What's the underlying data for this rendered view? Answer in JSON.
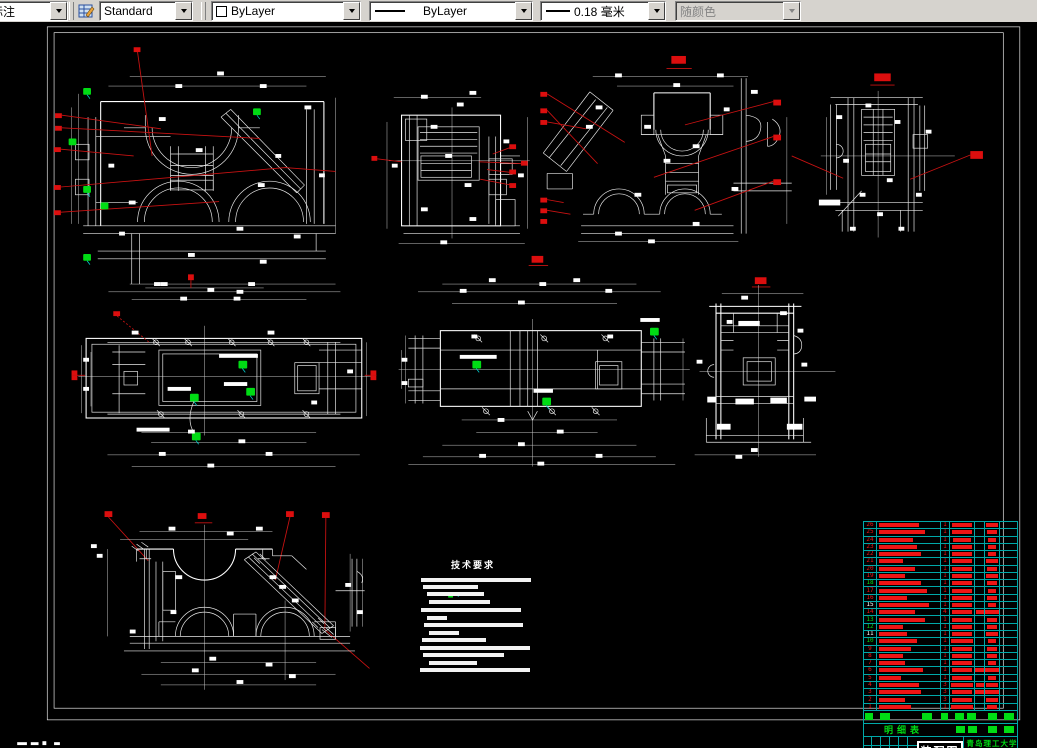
{
  "toolbar": {
    "dim_style_combo": "标注",
    "dim_style_icon": "dim-style-manager-icon",
    "text_style_combo": "Standard",
    "color_combo": "ByLayer",
    "linetype_combo": "ByLayer",
    "lineweight_combo": "0.18 毫米",
    "plotstyle_combo": "随颜色"
  },
  "colors": {
    "canvas_bg": "#000000",
    "linework": "#ffffff",
    "annotation_red": "#dc0e0e",
    "symbol_green": "#00dc14",
    "table_grid_cyan": "#00a8a8",
    "toolbar_gray": "#d6d3ce"
  },
  "drawing": {
    "tech_requirements_title": "技术要求",
    "bom_title": "明细表",
    "titleblock": {
      "drawing_name": "装配图",
      "organization": "青岛理工大学",
      "part_name": "中间体",
      "drawing_number": "KXR-2"
    }
  },
  "bom": {
    "rows": [
      {
        "n": "26",
        "nc": "red",
        "name_w": 40,
        "qty": "1",
        "mat_w": 20,
        "wt_w": 12
      },
      {
        "n": "25",
        "nc": "red",
        "name_w": 46,
        "qty": "1",
        "mat_w": 20,
        "wt_w": 10
      },
      {
        "n": "24",
        "nc": "red",
        "name_w": 34,
        "qty": "1",
        "mat_w": 18,
        "wt_w": 8
      },
      {
        "n": "23",
        "nc": "red",
        "name_w": 38,
        "qty": "1",
        "mat_w": 20,
        "wt_w": 8
      },
      {
        "n": "22",
        "nc": "red",
        "name_w": 42,
        "qty": "1",
        "mat_w": 20,
        "wt_w": 8
      },
      {
        "n": "21",
        "nc": "red",
        "name_w": 24,
        "qty": "1",
        "mat_w": 20,
        "wt_w": 12
      },
      {
        "n": "20",
        "nc": "red",
        "name_w": 36,
        "qty": "1",
        "mat_w": 20,
        "wt_w": 10
      },
      {
        "n": "19",
        "nc": "red",
        "name_w": 26,
        "qty": "1",
        "mat_w": 20,
        "wt_w": 12
      },
      {
        "n": "18",
        "nc": "green",
        "name_w": 42,
        "qty": "1",
        "mat_w": 20,
        "wt_w": 10
      },
      {
        "n": "17",
        "nc": "red",
        "name_w": 48,
        "qty": "1",
        "mat_w": 20,
        "wt_w": 8
      },
      {
        "n": "16",
        "nc": "red",
        "name_w": 28,
        "qty": "1",
        "mat_w": 20,
        "wt_w": 10
      },
      {
        "n": "15",
        "nc": "white",
        "name_w": 50,
        "qty": "1",
        "mat_w": 20,
        "wt_w": 8
      },
      {
        "n": "14",
        "nc": "red",
        "name_w": 36,
        "qty": "4",
        "mat_w": 20,
        "x5_w": 8,
        "wt_w": 14
      },
      {
        "n": "13",
        "nc": "green",
        "name_w": 46,
        "qty": "1",
        "mat_w": 20,
        "wt_w": 10
      },
      {
        "n": "12",
        "nc": "green",
        "name_w": 24,
        "qty": "1",
        "mat_w": 20,
        "wt_w": 10
      },
      {
        "n": "11",
        "nc": "white",
        "name_w": 28,
        "qty": "1",
        "mat_w": 20,
        "wt_w": 12
      },
      {
        "n": "10",
        "nc": "green",
        "name_w": 38,
        "qty": "1",
        "mat_w": 22,
        "wt_w": 8
      },
      {
        "n": "9",
        "nc": "red",
        "name_w": 32,
        "qty": "1",
        "mat_w": 20,
        "wt_w": 10
      },
      {
        "n": "8",
        "nc": "red",
        "name_w": 24,
        "qty": "1",
        "mat_w": 20,
        "wt_w": 10
      },
      {
        "n": "7",
        "nc": "red",
        "name_w": 26,
        "qty": "1",
        "mat_w": 20,
        "wt_w": 8
      },
      {
        "n": "6",
        "nc": "red",
        "name_w": 44,
        "qty": "1",
        "mat_w": 20,
        "x5_w": 10,
        "wt_w": 14
      },
      {
        "n": "5",
        "nc": "red",
        "name_w": 22,
        "qty": "1",
        "mat_w": 20,
        "wt_w": 8
      },
      {
        "n": "4",
        "nc": "red",
        "name_w": 40,
        "qty": "3",
        "mat_w": 22,
        "x5_w": 8,
        "wt_w": 12
      },
      {
        "n": "3",
        "nc": "red",
        "name_w": 42,
        "qty": "3",
        "mat_w": 20,
        "x5_w": 10,
        "wt_w": 14
      },
      {
        "n": "2",
        "nc": "red",
        "name_w": 26,
        "qty": "3",
        "mat_w": 20,
        "wt_w": 12
      },
      {
        "n": "1",
        "nc": "red",
        "name_w": 32,
        "qty": "1",
        "mat_w": 22,
        "wt_w": 10
      }
    ]
  }
}
